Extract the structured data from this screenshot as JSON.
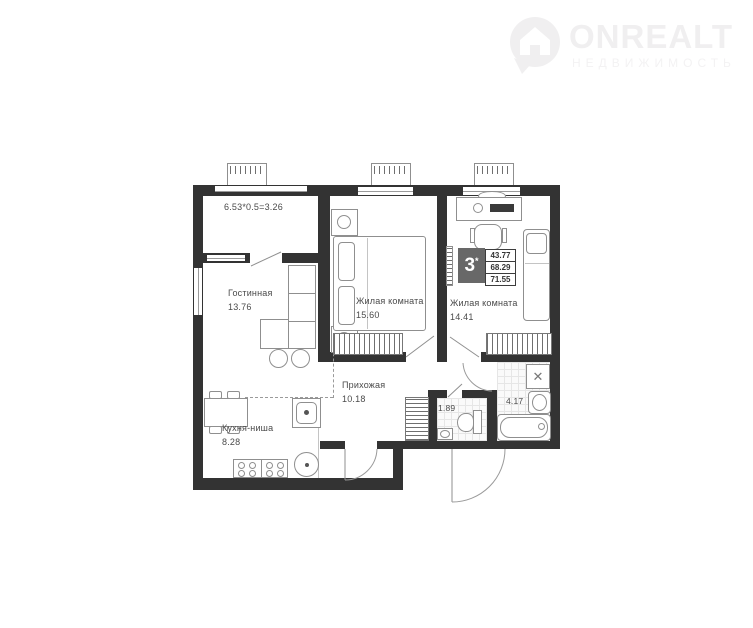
{
  "watermark": {
    "brand": "ONREALT",
    "subtitle": "НЕДВИЖИМОСТЬ"
  },
  "plan": {
    "balcony_formula": "6.53*0.5=3.26",
    "living": {
      "name": "Гостинная",
      "area": "13.76"
    },
    "room1": {
      "name": "Жилая комната",
      "area": "15.60"
    },
    "room2": {
      "name": "Жилая комната",
      "area": "14.41"
    },
    "hall": {
      "name": "Прихожая",
      "area": "10.18"
    },
    "kitchen": {
      "name": "Кухня-ниша",
      "area": "8.28"
    },
    "wc_area": "1.89",
    "bath_area": "4.17",
    "summary": {
      "rooms": "3",
      "star": "*",
      "values": [
        "43.77",
        "68.29",
        "71.55"
      ]
    },
    "colors": {
      "wall": "#333333",
      "watermark": "#f0eff0",
      "label_text": "#4a4a4a"
    }
  }
}
